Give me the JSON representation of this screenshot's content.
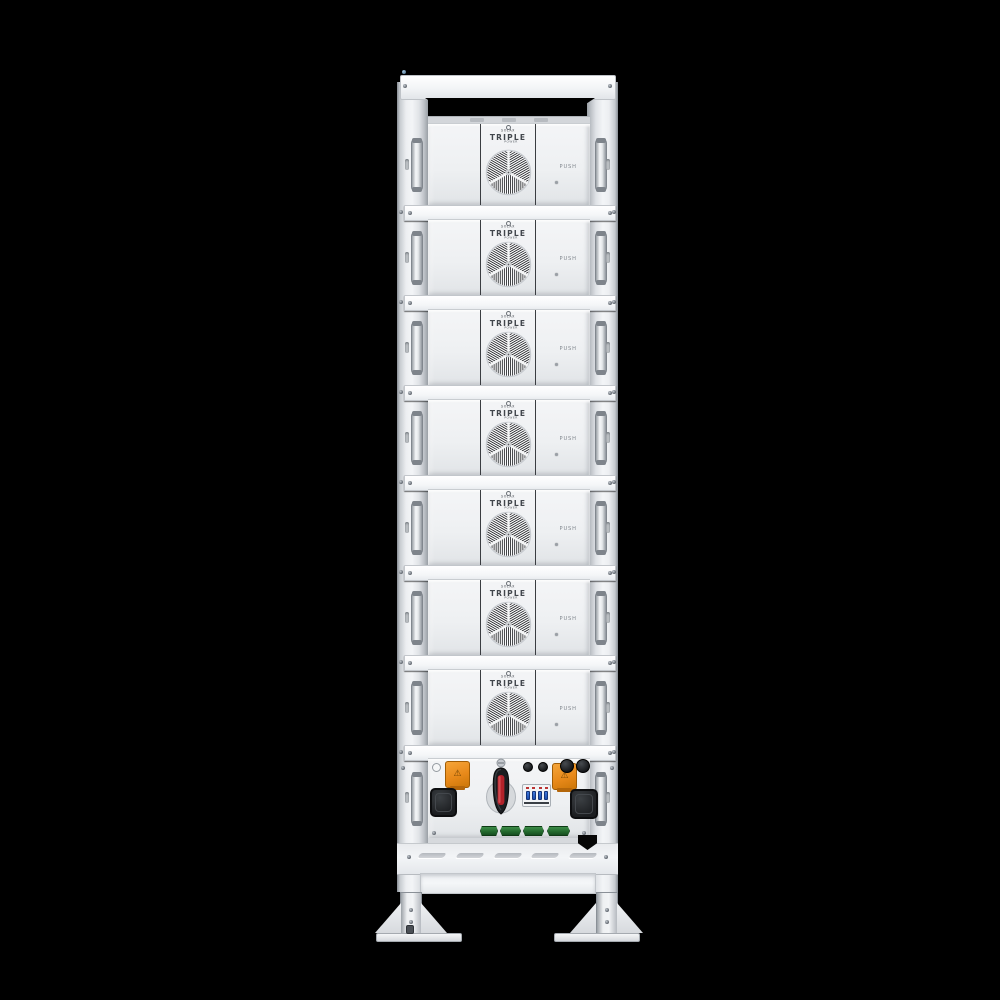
{
  "scene": {
    "background_color": "#000000",
    "subject": "battery-rack-energy-storage-tower-front-view"
  },
  "rack": {
    "module_count": 7,
    "shelf_rail_count": 7,
    "body_color": "#eef0f2"
  },
  "branding": {
    "logo_small": "SOLAX",
    "logo_main": "TRIPLE",
    "logo_sub": "POWER"
  },
  "modules": [
    {
      "logo_small": "SOLAX",
      "logo_main": "TRIPLE",
      "logo_sub": "POWER",
      "push_label": "PUSH"
    },
    {
      "logo_small": "SOLAX",
      "logo_main": "TRIPLE",
      "logo_sub": "POWER",
      "push_label": "PUSH"
    },
    {
      "logo_small": "SOLAX",
      "logo_main": "TRIPLE",
      "logo_sub": "POWER",
      "push_label": "PUSH"
    },
    {
      "logo_small": "SOLAX",
      "logo_main": "TRIPLE",
      "logo_sub": "POWER",
      "push_label": "PUSH"
    },
    {
      "logo_small": "SOLAX",
      "logo_main": "TRIPLE",
      "logo_sub": "POWER",
      "push_label": "PUSH"
    },
    {
      "logo_small": "SOLAX",
      "logo_main": "TRIPLE",
      "logo_sub": "POWER",
      "push_label": "PUSH"
    },
    {
      "logo_small": "SOLAX",
      "logo_main": "TRIPLE",
      "logo_sub": "POWER",
      "push_label": "PUSH"
    }
  ],
  "control_unit": {
    "main_switch": "rotary-disconnect-switch",
    "breaker_pole_count": 4,
    "orange_power_connector_count": 2,
    "black_rubber_port_count": 2,
    "terminal_cap_small_count": 2,
    "terminal_cap_large_count": 2,
    "comm_port_count": 4,
    "indicator_count": 1
  },
  "base": {
    "vent_slot_count": 5,
    "foot_count": 2
  },
  "colors": {
    "accent_orange": "#e8891a",
    "switch_red": "#b2222a",
    "breaker_blue": "#2a5fd0",
    "comm_port_green": "#2e7d32",
    "dark_part": "#1b1d20",
    "rail_white": "#fbfcfd"
  }
}
